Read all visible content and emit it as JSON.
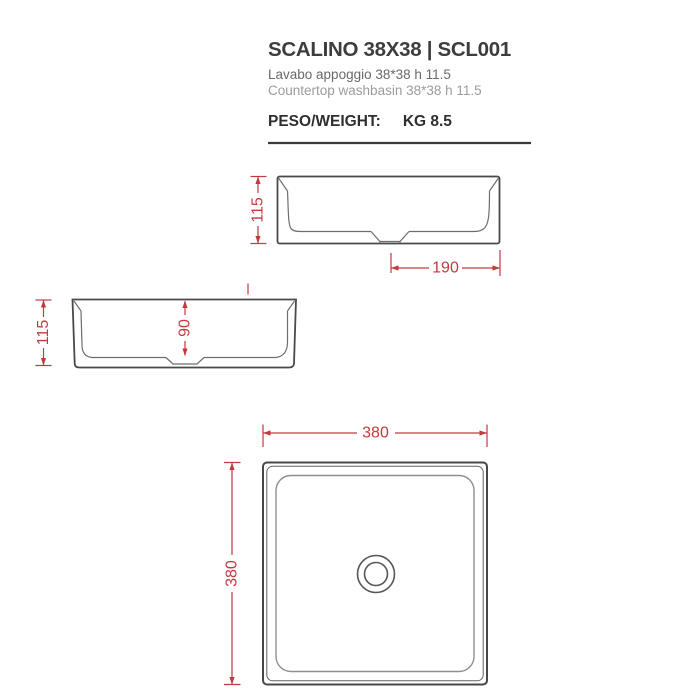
{
  "header": {
    "title": "SCALINO 38X38 | SCL001",
    "subtitle_it": "Lavabo appoggio 38*38 h 11.5",
    "subtitle_en": "Countertop washbasin 38*38 h 11.5",
    "weight_label": "PESO/WEIGHT:",
    "weight_value": "KG 8.5"
  },
  "colors": {
    "dimension_red": "#c23a3e",
    "outline_dark": "#4a4a4a",
    "outline_mid": "#6e6e6e",
    "outline_light": "#8f8f8f",
    "title_text": "#3d3d3d",
    "subtitle_it_text": "#6a6a6a",
    "subtitle_en_text": "#9c9c9c"
  },
  "views": {
    "front": {
      "dim_height": "115",
      "dim_drain_to_edge": "190"
    },
    "side": {
      "dim_height": "115",
      "dim_inner_depth": "90"
    },
    "plan": {
      "dim_width": "380",
      "dim_depth": "380"
    }
  }
}
